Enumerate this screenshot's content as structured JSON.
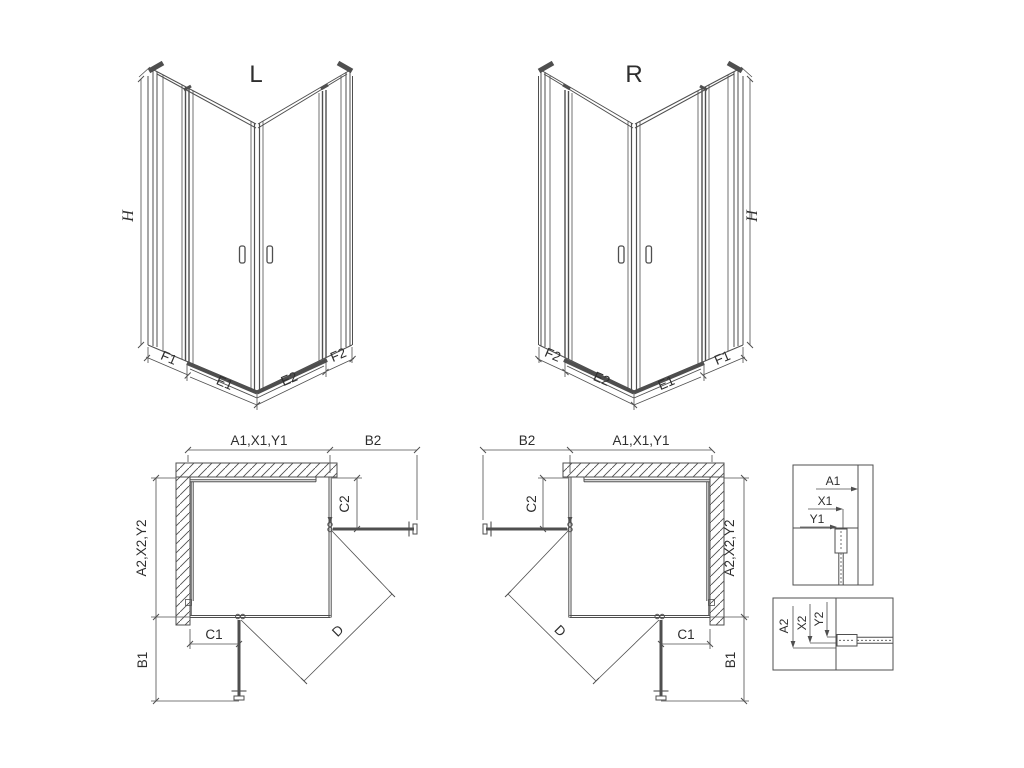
{
  "drawing": {
    "iso_left": {
      "title": "L",
      "height_label": "H",
      "segments": [
        "F1",
        "E1",
        "E2",
        "F2"
      ]
    },
    "iso_right": {
      "title": "R",
      "height_label": "H",
      "segments": [
        "F2",
        "E2",
        "E1",
        "F1"
      ]
    },
    "plan_left": {
      "width_top": "A1,X1,Y1",
      "extension_top": "B2",
      "depth_side": "A2,X2,Y2",
      "extension_side": "B1",
      "fixed_top": "C2",
      "fixed_bottom": "C1",
      "diagonal": "D"
    },
    "plan_right": {
      "width_top": "A1,X1,Y1",
      "extension_top": "B2",
      "depth_side": "A2,X2,Y2",
      "extension_side": "B1",
      "fixed_top": "C2",
      "fixed_bottom": "C1",
      "diagonal": "D"
    },
    "detail_top": {
      "labels": [
        "A1",
        "X1",
        "Y1"
      ]
    },
    "detail_bottom": {
      "labels": [
        "A2",
        "X2",
        "Y2"
      ]
    },
    "colors": {
      "line": "#4f4f4f",
      "thick": "#3d3d3d",
      "light": "#909090",
      "text": "#2e2e2e"
    }
  }
}
